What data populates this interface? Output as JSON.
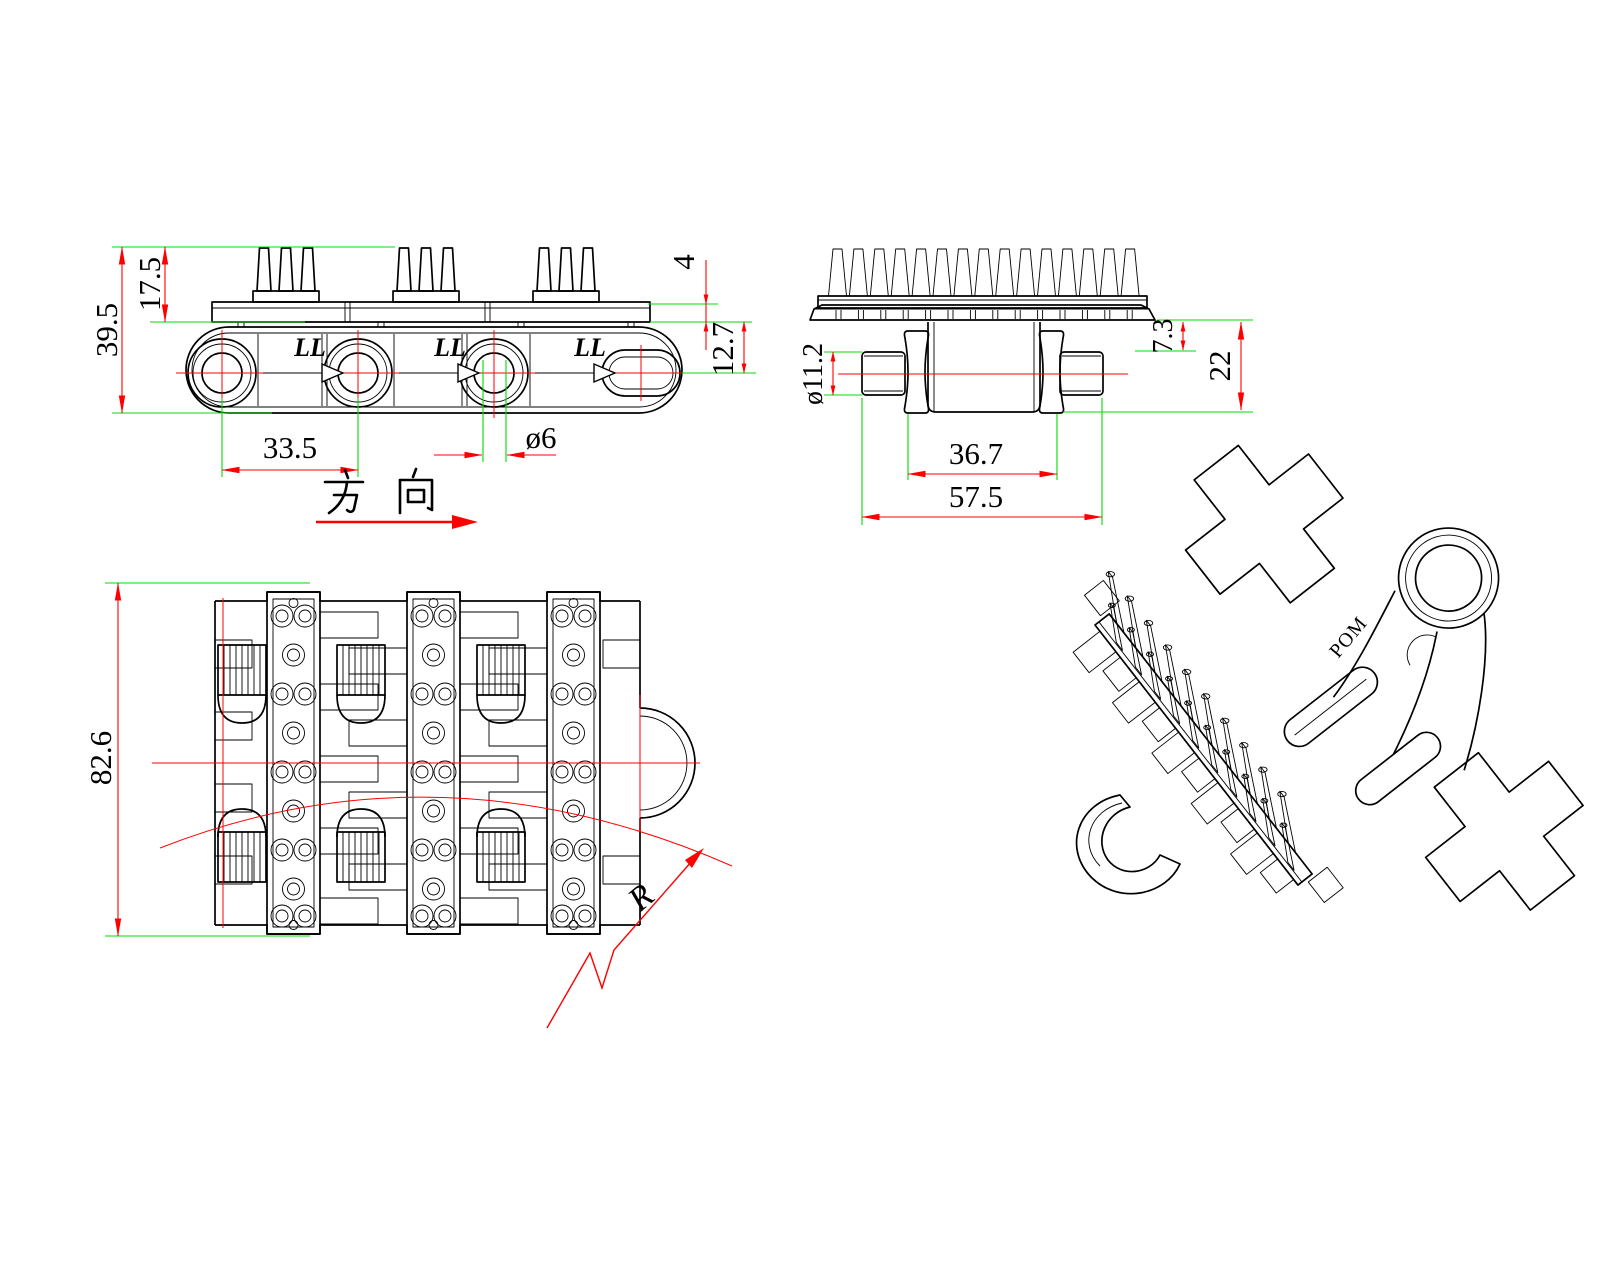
{
  "document": {
    "type": "engineering-drawing",
    "background": "#ffffff"
  },
  "colors": {
    "outline": "#000000",
    "dimension": "#ff0000",
    "extension": "#00dd00"
  },
  "labels": {
    "direction": "方 向",
    "flow": "LL"
  },
  "side_view": {
    "dims": {
      "overall_height": "39.5",
      "spike_height": "17.5",
      "pitch": "33.5",
      "hole_diameter": "ø6",
      "plate_thickness": "4",
      "plate_to_center": "12.7"
    }
  },
  "end_view": {
    "dims": {
      "pin_diameter": "ø11.2",
      "edge_drop": "7.3",
      "body_height": "22",
      "hinge_span": "36.7",
      "overall_width": "57.5"
    }
  },
  "plan_view": {
    "dims": {
      "module_width": "82.6",
      "bend_radius": "R"
    }
  },
  "iso_view": {
    "material_marking": "POM"
  }
}
